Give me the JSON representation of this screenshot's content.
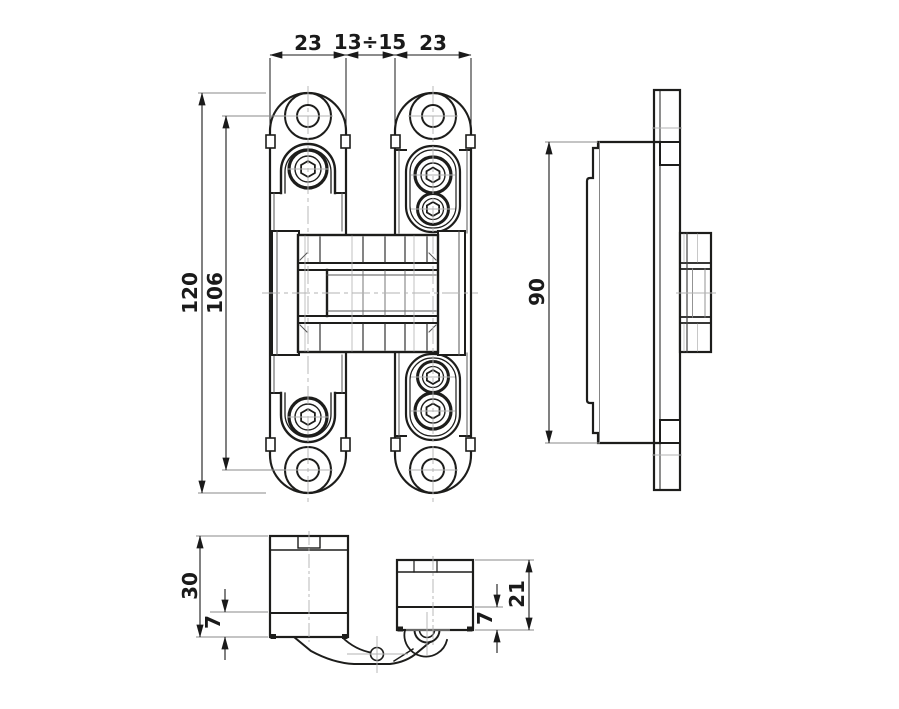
{
  "drawing": {
    "kind": "concealed-hinge-technical-drawing",
    "line_color": "#1d1d1b",
    "thin_line_color": "#9b9b9b",
    "background": "#ffffff"
  },
  "views": {
    "front": {
      "dims": {
        "plate_width_left": "23",
        "center_gap": "13÷15",
        "plate_width_right": "23",
        "total_height": "120",
        "hole_spacing": "106"
      }
    },
    "side": {
      "dims": {
        "body_height": "90"
      }
    },
    "bottom": {
      "dims": {
        "left_block_height": "30",
        "left_block_base": "7",
        "right_block_height": "21",
        "right_block_base": "7"
      }
    }
  }
}
